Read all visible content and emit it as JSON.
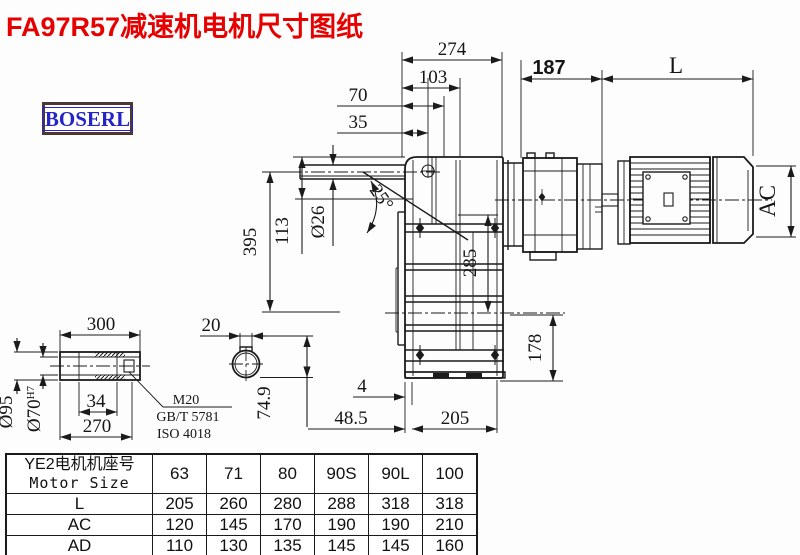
{
  "title": "FA97R57减速机电机尺寸图纸",
  "brand": "BOSERL",
  "colors": {
    "title_red": "#e60000",
    "logo_blue": "#2424c8",
    "logo_border": "#4d3836",
    "line_black": "#1b1b1b"
  },
  "drawing": {
    "top_dims": {
      "d274": "274",
      "d103": "103",
      "d70": "70",
      "d35": "35"
    },
    "motor_dims": {
      "d187": "187",
      "dL": "L",
      "dAC": "AC"
    },
    "side_dims": {
      "d395": "395",
      "d113": "113",
      "d26": "Ø26",
      "angle": "25°",
      "d285": "285",
      "d178": "178"
    },
    "bottom_dims": {
      "d4": "4",
      "d48_5": "48.5",
      "d205": "205"
    },
    "shaft_detail": {
      "d300": "300",
      "d34": "34",
      "d270": "270",
      "d95": "Ø95",
      "d70": "Ø70",
      "tol": "H7",
      "thread": "M20",
      "std1": "GB/T 5781",
      "std2": "ISO 4018"
    },
    "bore_detail": {
      "d20": "20",
      "d74_9": "74.9"
    }
  },
  "table": {
    "header_cn": "YE2电机机座号",
    "header_en": "Motor Size",
    "sizes": [
      "63",
      "71",
      "80",
      "90S",
      "90L",
      "100"
    ],
    "rows": [
      {
        "label": "L",
        "values": [
          "205",
          "260",
          "280",
          "288",
          "318",
          "318"
        ]
      },
      {
        "label": "AC",
        "values": [
          "120",
          "145",
          "170",
          "190",
          "190",
          "210"
        ]
      },
      {
        "label": "AD",
        "values": [
          "110",
          "130",
          "135",
          "145",
          "145",
          "160"
        ]
      }
    ]
  }
}
